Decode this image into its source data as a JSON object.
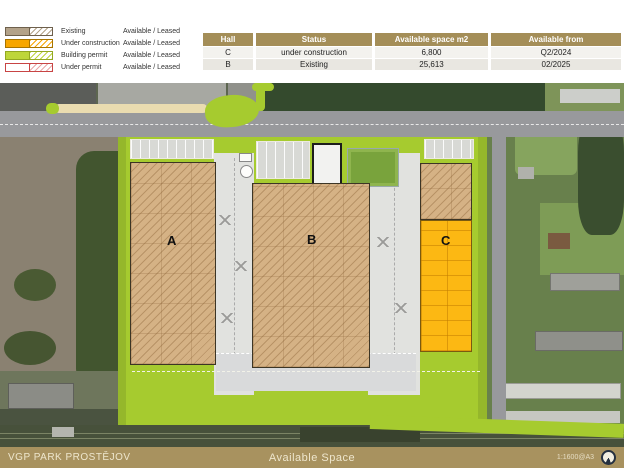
{
  "legend": {
    "items": [
      {
        "label": "Existing",
        "availability": "Available / Leased",
        "color": "#b3a289"
      },
      {
        "label": "Under construction",
        "availability": "Available / Leased",
        "color": "#f7a600"
      },
      {
        "label": "Building permit",
        "availability": "Available / Leased",
        "color": "#bed63a"
      },
      {
        "label": "Under permit",
        "availability": "Available / Leased",
        "color": "#ffffff"
      }
    ]
  },
  "table": {
    "headers": [
      "Hall",
      "Status",
      "Available space m2",
      "Available from"
    ],
    "rows": [
      {
        "hall": "C",
        "status": "under construction",
        "space": "6,800",
        "from": "Q2/2024"
      },
      {
        "hall": "B",
        "status": "Existing",
        "space": "25,613",
        "from": "02/2025"
      }
    ]
  },
  "map": {
    "halls": [
      {
        "label": "A",
        "status": "existing"
      },
      {
        "label": "B",
        "status": "existing"
      },
      {
        "label": "C",
        "status": "under construction"
      }
    ]
  },
  "footer": {
    "park_name": "VGP PARK PROSTĚJOV",
    "page_title": "Available Space",
    "scale": "1:1600@A3"
  },
  "colors": {
    "park_green": "#a6cb2f",
    "existing_tan": "#d5b285",
    "under_construction_orange": "#fcb813",
    "table_header_gold": "#a48e58",
    "footer_gold": "#a8925f"
  }
}
